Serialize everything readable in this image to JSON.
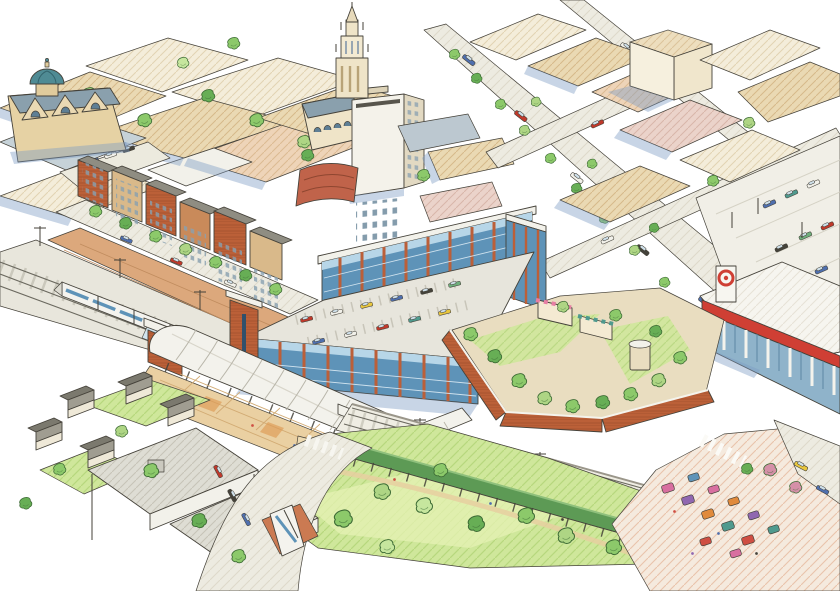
{
  "image": {
    "kind": "hand-drawn aerial architectural rendering",
    "description": "Watercolor-and-ink bird's-eye rendering of a proposed downtown transit-center district: a domed church and cathedral spire uptown, a white high-rise, tree-lined streets, a glass-and-brick mixed-use garage with rooftop parking, an arched white station canopy over rail platforms with a commuter train, a raised terrace garden with kiosks, a big-box store with red band and bullseye pylon sign, a park lawn with long pergola and amphitheater steps, a colorful market plaza, and a residential neighborhood with a bus loop.",
    "visible_text": []
  },
  "palette": {
    "ink": "#45423a",
    "paper": "#ffffff",
    "shadow": "#7d9cc4",
    "tree": "#8cc96a",
    "tree_light": "#aed584",
    "tree_dark": "#67ae55",
    "tree_pale": "#c6e69e",
    "blossom": "#d590a8",
    "lawn": "#cfe79b",
    "glass": "#5e93b8",
    "glass_light": "#b7d6e8",
    "brick": "#bb5f39",
    "dome": "#4f8b94",
    "tan": "#ead9b3",
    "cream": "#f4edda",
    "peach": "#eed4b8",
    "pink_bldg": "#ebd3ca",
    "roof_gray": "#deddd4",
    "road": "#edebe1",
    "accent_red": "#cf3f34",
    "taxi": "#e8c63e",
    "bus_white": "#f4f3ee",
    "platform_brick": "#dca87c",
    "canopy_white": "#f3f2ec"
  },
  "scene": {
    "elements": [
      {
        "name": "domed-church",
        "desc": "tan gabled church with teal dome, upper left"
      },
      {
        "name": "cathedral-tower",
        "desc": "ornate cream spired tower, top center"
      },
      {
        "name": "highrise-tower",
        "desc": "white tower with dark window grid"
      },
      {
        "name": "downtown-blocks",
        "desc": "hatched tan low-rise commercial blocks"
      },
      {
        "name": "main-street",
        "desc": "diagonal tree-lined street with cars"
      },
      {
        "name": "northeast-parking-lot",
        "desc": "striped surface lot with parked cars"
      },
      {
        "name": "big-box-store",
        "desc": "white store, red parapet band, bullseye pylon sign"
      },
      {
        "name": "townhouse-row",
        "desc": "brick rowhouses stepping along station street"
      },
      {
        "name": "rail-corridor",
        "desc": "electrified double track with white commuter train"
      },
      {
        "name": "mixed-use-garage",
        "desc": "blue glass and brick building with rooftop parking deck full of cars"
      },
      {
        "name": "transit-canopy",
        "desc": "long barrel-vaulted white canopy with brick end pavilions"
      },
      {
        "name": "station-plaza",
        "desc": "checkered paved plaza with curved amphitheater steps"
      },
      {
        "name": "terrace-garden",
        "desc": "raised planted terrace with awning kiosks and brick retaining wall"
      },
      {
        "name": "great-lawn",
        "desc": "park lawn with scattered trees and long green pergola"
      },
      {
        "name": "market-plaza",
        "desc": "colorful market stalls and flowering trees, lower right"
      },
      {
        "name": "residential-neighborhood",
        "desc": "gray gabled houses and flat-roof warehouses, lower left"
      },
      {
        "name": "bus-loop",
        "desc": "curved roadway with white bus at red-brick bus stop"
      }
    ]
  }
}
